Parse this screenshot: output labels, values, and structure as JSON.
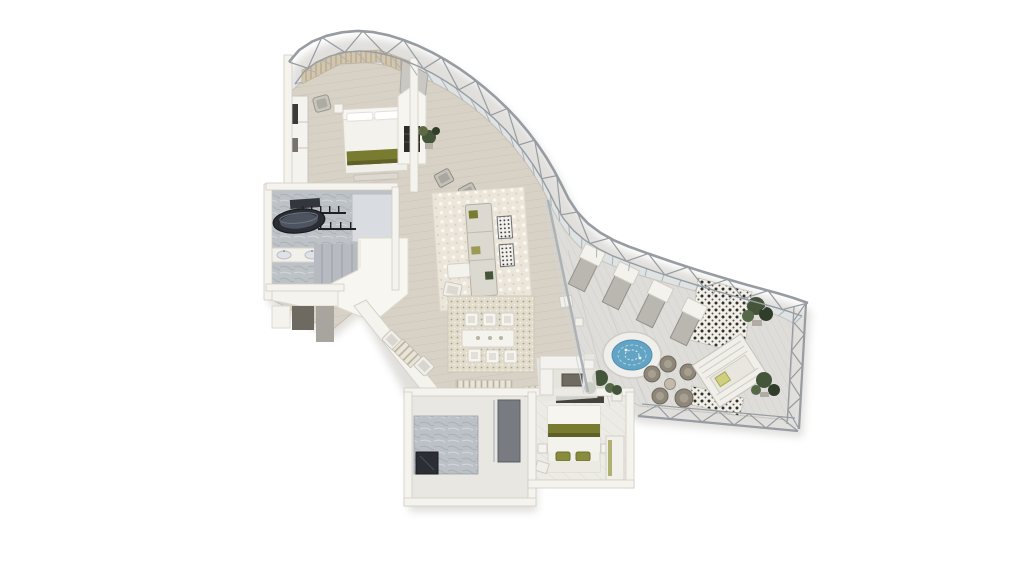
{
  "title": "penthouse-suite-floorplan-render",
  "palette": {
    "bg": "#ffffff",
    "wood": "#d8d1c6",
    "wood_line": "#c2bAAb",
    "deck": "#deddd9",
    "deck_line": "#c9c8c3",
    "wall": "#f5f3ee",
    "wall_edge": "#d2cec6",
    "wall_shadow": "#b8b4ac",
    "structure": "#979ca2",
    "glass": "#dfe6ea",
    "glass_mullion": "#abb2b8",
    "marble": "#bcc1c7",
    "marble_dark": "#8e949c",
    "fixture_dark": "#2b2e35",
    "accent_olive": "#797b31",
    "accent_olive_dark": "#5f6126",
    "plant": "#44553a",
    "plant_dark": "#2f3d2a",
    "water": "#63a3c4",
    "water_light": "#a9d2e2",
    "tile_dark": "#30302c",
    "tile_light": "#f1efe8",
    "rug_living": "#ece6da",
    "rug_dining": "#e2dccc",
    "rug_motif": "#a89f8c",
    "sofa": "#dcd9d1",
    "furn_gray": "#b9b7af",
    "wicker": "#8f887a",
    "cushion_yellow": "#cfcf7f",
    "shadow": "#8a867c"
  },
  "scene": {
    "rooms": [
      {
        "name": "master-bedroom",
        "items": [
          "double-bed",
          "olive-throw",
          "armchair",
          "wardrobe",
          "slat-feature-wall"
        ]
      },
      {
        "name": "master-bathroom",
        "items": [
          "dark-oval-bathtub",
          "double-vanity",
          "glazed-partition",
          "shower"
        ]
      },
      {
        "name": "hallway",
        "items": [
          "steps",
          "closet-niches",
          "white-roof-plate"
        ]
      },
      {
        "name": "living-room",
        "items": [
          "sofa",
          "chaise",
          "coffee-table",
          "patterned-side-tables",
          "armchairs",
          "fireplace-column",
          "plant",
          "area-rug"
        ]
      },
      {
        "name": "dining-room",
        "items": [
          "dining-table",
          "six-chairs",
          "striped-console",
          "patterned-rug"
        ]
      },
      {
        "name": "guest-bedroom",
        "items": [
          "double-bed",
          "olive-band",
          "two-olive-pillows",
          "nightstands",
          "bench"
        ]
      },
      {
        "name": "guest-bathroom",
        "items": [
          "sunken-tub",
          "shower-column",
          "marble-floor"
        ]
      },
      {
        "name": "terrace",
        "items": [
          "sun-loungers",
          "hot-tub",
          "wicker-chat-set",
          "daybed-cabana",
          "patterned-tiles",
          "planters",
          "outdoor-sofa"
        ]
      }
    ],
    "counts": {
      "sun_loungers": 4,
      "dining_chairs": 6,
      "wicker_chairs": 4,
      "olive_pillows": 2,
      "planters": 4
    },
    "facade": {
      "type": "curved-glass-curtain-wall",
      "structure": "steel-truss"
    }
  }
}
